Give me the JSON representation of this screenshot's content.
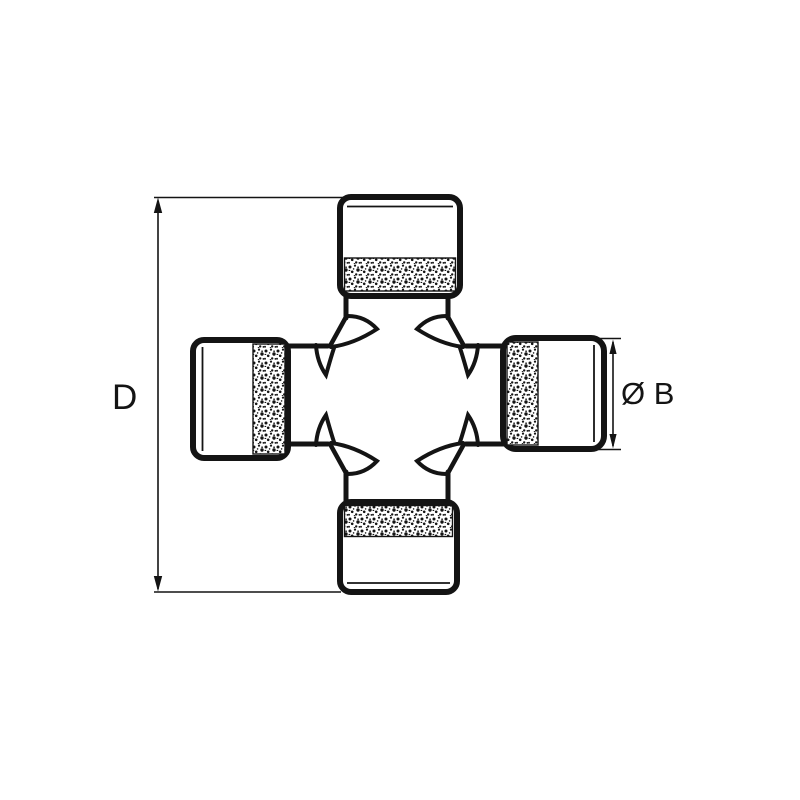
{
  "page": {
    "background_color": "#ffffff",
    "line_color": "#141414"
  },
  "drawing": {
    "subject": "universal-joint-cross-journal",
    "labels": {
      "overall_diameter": "D",
      "cup_diameter": "Ø B"
    }
  }
}
